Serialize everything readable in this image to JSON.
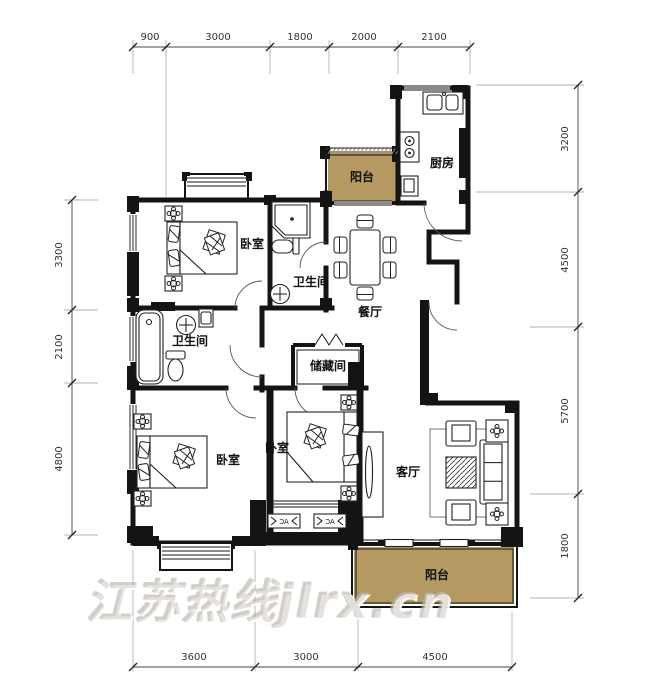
{
  "plan": {
    "rooms": {
      "balcony_top": "阳台",
      "kitchen": "厨房",
      "bedroom_top": "卧室",
      "bathroom_top": "卫生间",
      "dining": "餐厅",
      "bathroom_mid": "卫生间",
      "storage": "储藏间",
      "bedroom_left": "卧室",
      "bedroom_mid": "卧室",
      "living": "客厅",
      "balcony_bottom": "阳台",
      "ac": "AC"
    },
    "dimensions": {
      "top": [
        "900",
        "3000",
        "1800",
        "2000",
        "2100"
      ],
      "left": [
        "3300",
        "2100",
        "4800"
      ],
      "right": [
        "3200",
        "4500",
        "5700",
        "1800"
      ],
      "bottom": [
        "3600",
        "3000",
        "4500"
      ]
    },
    "watermark": "江苏热线jlrx.cn",
    "colors": {
      "balcony_fill": "#b49a62",
      "wall": "#141414",
      "dim_text": "#333333",
      "watermark": "rgba(205,200,192,0.5)"
    }
  }
}
